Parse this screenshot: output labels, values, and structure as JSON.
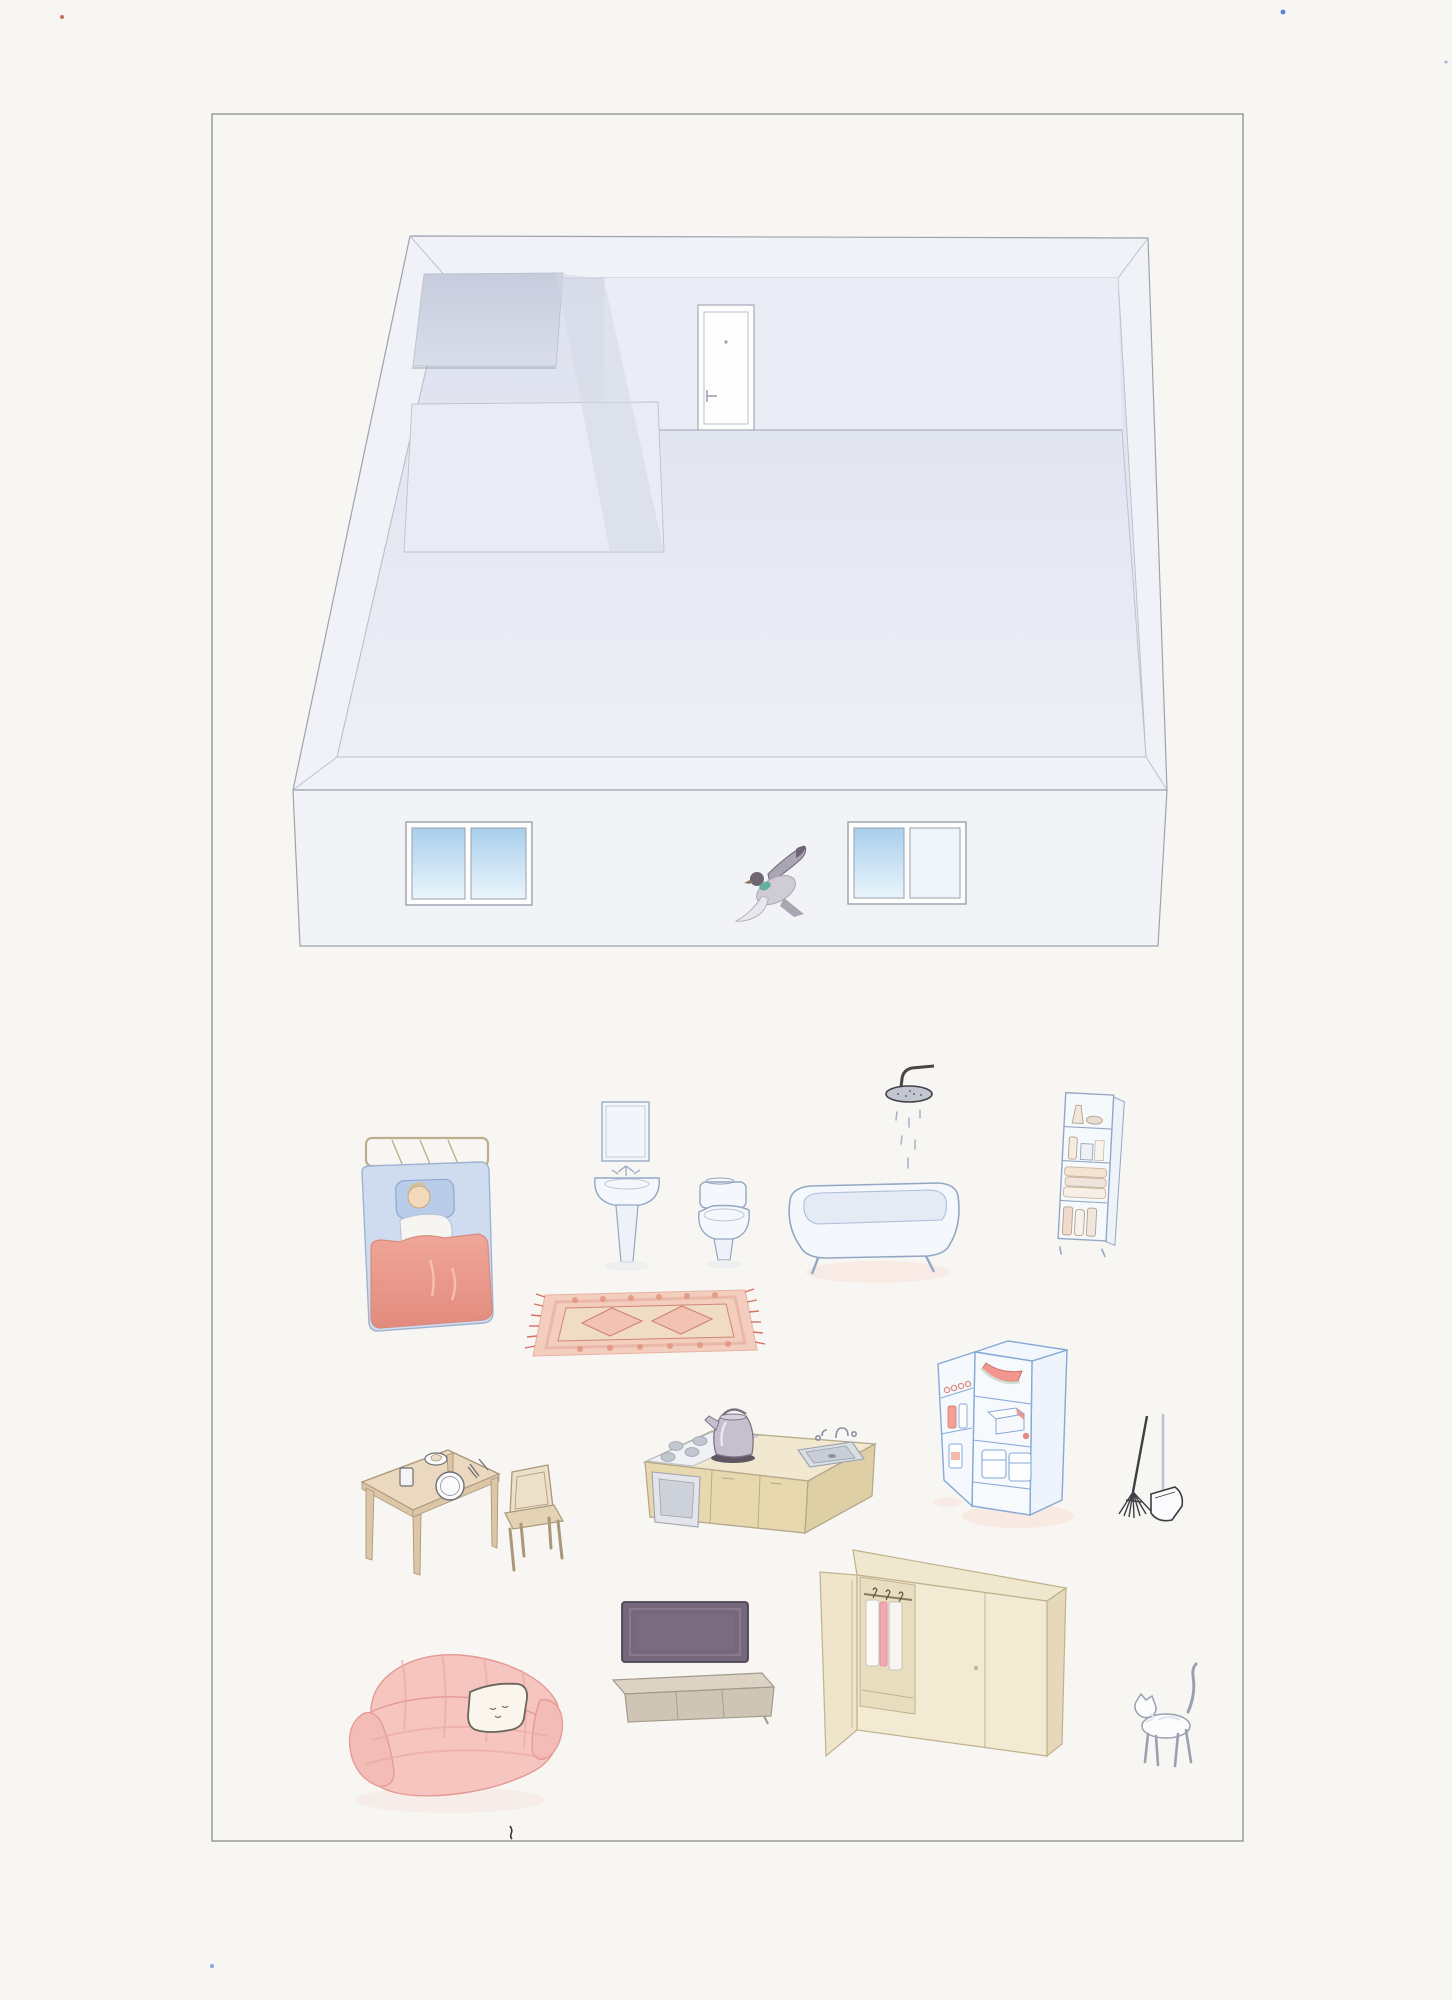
{
  "artwork": {
    "type": "watercolor illustration (scanned)",
    "title": "Isometric empty apartment with furniture laid out below",
    "regions": {
      "top": "empty isometric apartment shell with entry door, two small side rooms, facade with two windows and a flying pigeon",
      "bottom": "furniture and objects arranged on white paper"
    },
    "items": [
      {
        "id": "room-shell",
        "label": "empty isometric apartment"
      },
      {
        "id": "entry-door",
        "label": "entry door on back wall"
      },
      {
        "id": "closet-room",
        "label": "small dark side room (closet)"
      },
      {
        "id": "bathroom-floor",
        "label": "small side room floor outline"
      },
      {
        "id": "facade-window-left",
        "label": "facade window with blue sky"
      },
      {
        "id": "facade-window-right",
        "label": "facade window with blue sky"
      },
      {
        "id": "pigeon",
        "label": "flying pigeon with teal neck"
      },
      {
        "id": "bed",
        "label": "single bed with sleeping person and red blanket"
      },
      {
        "id": "sink",
        "label": "pedestal sink with mirror"
      },
      {
        "id": "toilet",
        "label": "toilet"
      },
      {
        "id": "shower-head",
        "label": "shower head with falling water"
      },
      {
        "id": "bathtub",
        "label": "bathtub on small feet"
      },
      {
        "id": "bathroom-shelf",
        "label": "narrow shelf with bottles and towels"
      },
      {
        "id": "rug",
        "label": "pink oriental rug with diamonds and fringe"
      },
      {
        "id": "dining-table",
        "label": "wooden table with plate, glass and cutlery"
      },
      {
        "id": "chair",
        "label": "wooden chair"
      },
      {
        "id": "kitchen-counter",
        "label": "kitchen counter with stove, sink and kettle"
      },
      {
        "id": "fridge",
        "label": "open refrigerator with food inside"
      },
      {
        "id": "mop",
        "label": "mop"
      },
      {
        "id": "dustpan",
        "label": "dustpan on handle"
      },
      {
        "id": "tv",
        "label": "flat TV screen"
      },
      {
        "id": "tv-stand",
        "label": "low TV stand"
      },
      {
        "id": "wardrobe",
        "label": "wardrobe with open door and hanging clothes"
      },
      {
        "id": "sofa",
        "label": "pink striped sofa"
      },
      {
        "id": "sleeping-cat",
        "label": "white cat curled on sofa"
      },
      {
        "id": "walking-cat",
        "label": "white cat walking, tail up"
      }
    ]
  },
  "palette": {
    "paper": "#f7f6f2",
    "border": "#8d8d8b",
    "pencil": "#9ca2af",
    "pencilSoft": "#bcc1ce",
    "wallTop": "#f0f2f7",
    "floorTop": "#dde1ee",
    "floorBottom": "#edeff6",
    "backWall": "#eaedf5",
    "closetDark": "#c7ccdd",
    "closetLight": "#dadeea",
    "shadeWall": "#d3d8e6",
    "facade": "#f2f3f7",
    "skyTop": "#a8cfec",
    "skyBottom": "#eaf5fc",
    "white": "#fdfdfd",
    "fixture": "#f4f7fb",
    "fixtureLine": "#93a7c4",
    "fixtureShade": "#e4ebf4",
    "blanketTop": "#efa698",
    "blanketBottom": "#e28b7e",
    "sheet": "#cfdcef",
    "sheetLine": "#9fb3d1",
    "pillow": "#b9cce9",
    "skin": "#f3d9bb",
    "hair": "#d9bd85",
    "shirt": "#f7f5f2",
    "brass": "#bfae8e",
    "rugBase": "#f3cdbd",
    "rugBand": "#e7b3a4",
    "rugDark": "#d0826f",
    "rugField": "#f0dcc6",
    "rugFringe": "#d96f62",
    "wood": "#ead9bf",
    "woodDark": "#dcc6a6",
    "woodLine": "#ab977c",
    "counterTop": "#f1e8cf",
    "counterFront": "#e7d8ae",
    "counterSide": "#dfcfa4",
    "counterLine": "#b5a88c",
    "stoveWhite": "#f0f1f4",
    "metal": "#c2c6cf",
    "metalDark": "#9aa0ae",
    "ovenGlass": "#cdd1d9",
    "kettle": "#c6bfcd",
    "kettleDark": "#5f5662",
    "fridgeLine": "#86a9d6",
    "fridgeFill": "#f7fafd",
    "fridgeSide": "#eef4fb",
    "watermelon": "#f2958c",
    "melonRind": "#cfe0d2",
    "foodRed": "#e08a80",
    "tvScreen": "#75687a",
    "tvEdge": "#4e4452",
    "tvBezel": "#938798",
    "standTop": "#ddd3c4",
    "standFront": "#cfc5b4",
    "standLine": "#a39a8c",
    "wardrobeTop": "#f0e7cf",
    "wardrobeFront": "#f2ead2",
    "wardrobeSide": "#e6d9ba",
    "wardrobeInner": "#e9ddc0",
    "wardrobeLine": "#c2b18d",
    "clothesPink": "#f2a9b4",
    "sofaBase": "#f6c5c0",
    "sofaShade": "#efaca6",
    "sofaLine": "#e39a94",
    "cushion": "#faf6ee",
    "inkDark": "#4a463f",
    "catLine": "#99a1b1",
    "catShade": "#e2e7ef",
    "pigeonGray": "#cfccd6",
    "pigeonMid": "#a9a5b2",
    "pigeonDark": "#6e6673",
    "pigeonTeal": "#66b0a0",
    "shadowPink": "#f8e6e0",
    "shadowGray": "#ececf0",
    "speckBlue": "#3a6ed0",
    "speckRed": "#c24a3a"
  }
}
